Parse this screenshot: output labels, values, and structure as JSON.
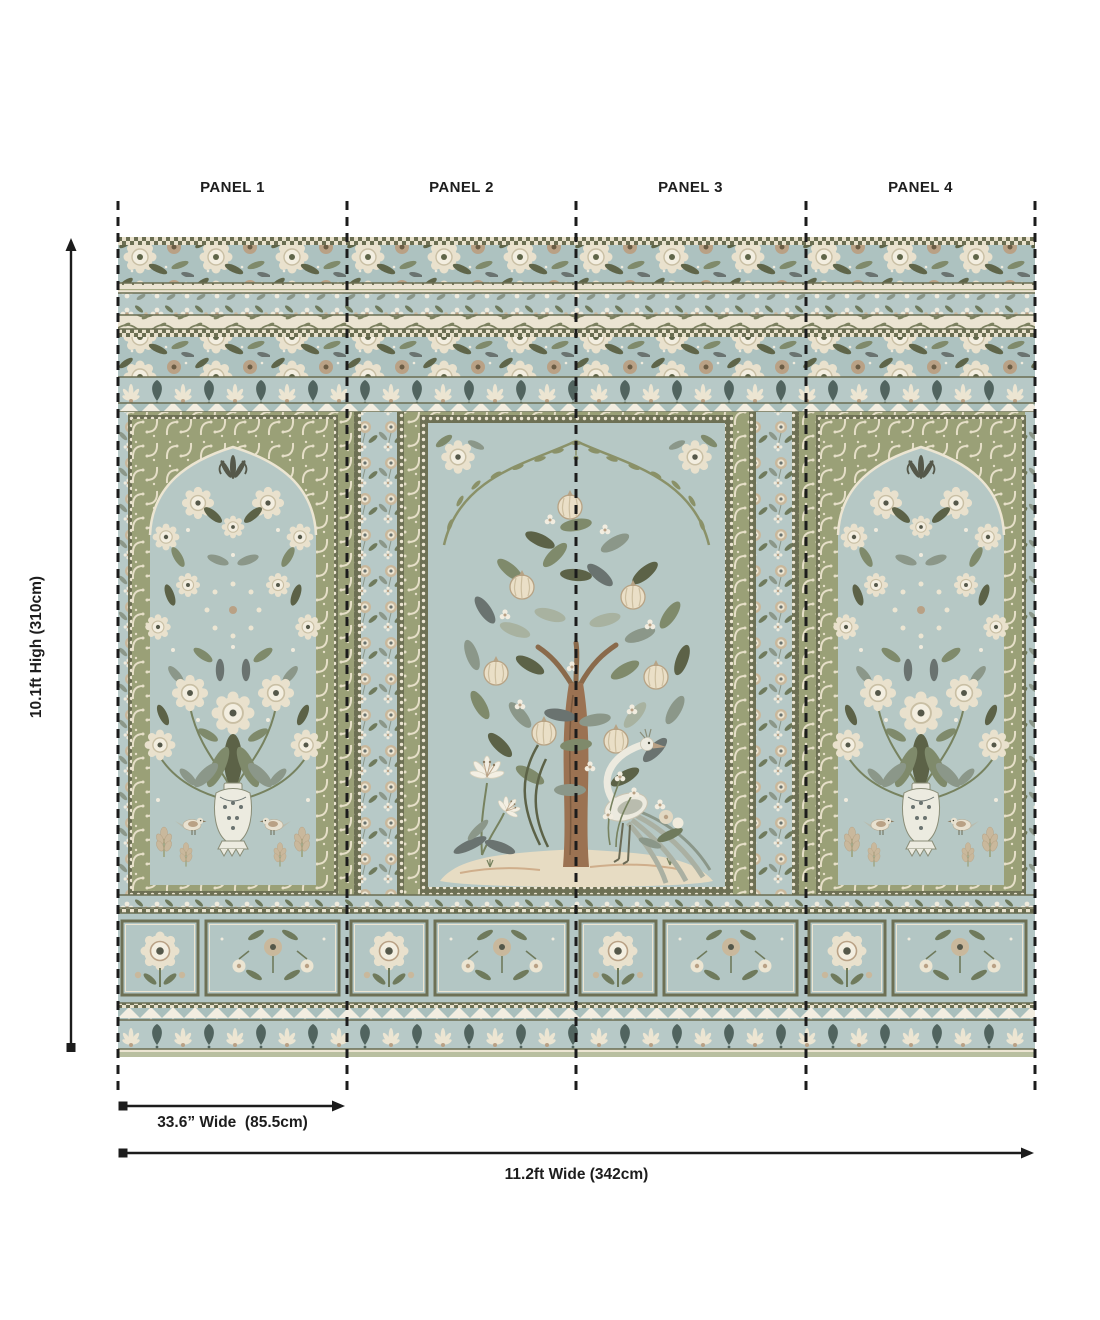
{
  "page": {
    "background_color": "#ffffff",
    "annotation_color": "#1d1d1d"
  },
  "panels": [
    {
      "label": "PANEL 1"
    },
    {
      "label": "PANEL 2"
    },
    {
      "label": "PANEL 3"
    },
    {
      "label": "PANEL 4"
    }
  ],
  "dimensions": {
    "height": "10.1ft High (310cm)",
    "panel_width": "33.6” Wide  (85.5cm)",
    "total_width": "11.2ft Wide (342cm)"
  },
  "mural": {
    "palette": {
      "field_blue": "#b2c4c2",
      "niche_blue": "#b6c8c5",
      "sage": "#9aa077",
      "olive_dark": "#5c6247",
      "green_mid": "#7f8a6b",
      "green_gray": "#8b9789",
      "slate": "#6a7370",
      "cream": "#ece5d2",
      "tan": "#b9a185",
      "trunk_brown": "#9b7252",
      "teal_dark": "#51645f",
      "sand": "#e7dcc3",
      "frame_olive": "#6d7054"
    },
    "elements": [
      "ornamental-top-border-bands",
      "left-floral-niche-with-vase",
      "center-niche-tree-of-life",
      "crane-bird",
      "white-lilies",
      "right-floral-niche-with-vase",
      "bottom-floral-compartment-band",
      "lambrequin-border"
    ]
  }
}
